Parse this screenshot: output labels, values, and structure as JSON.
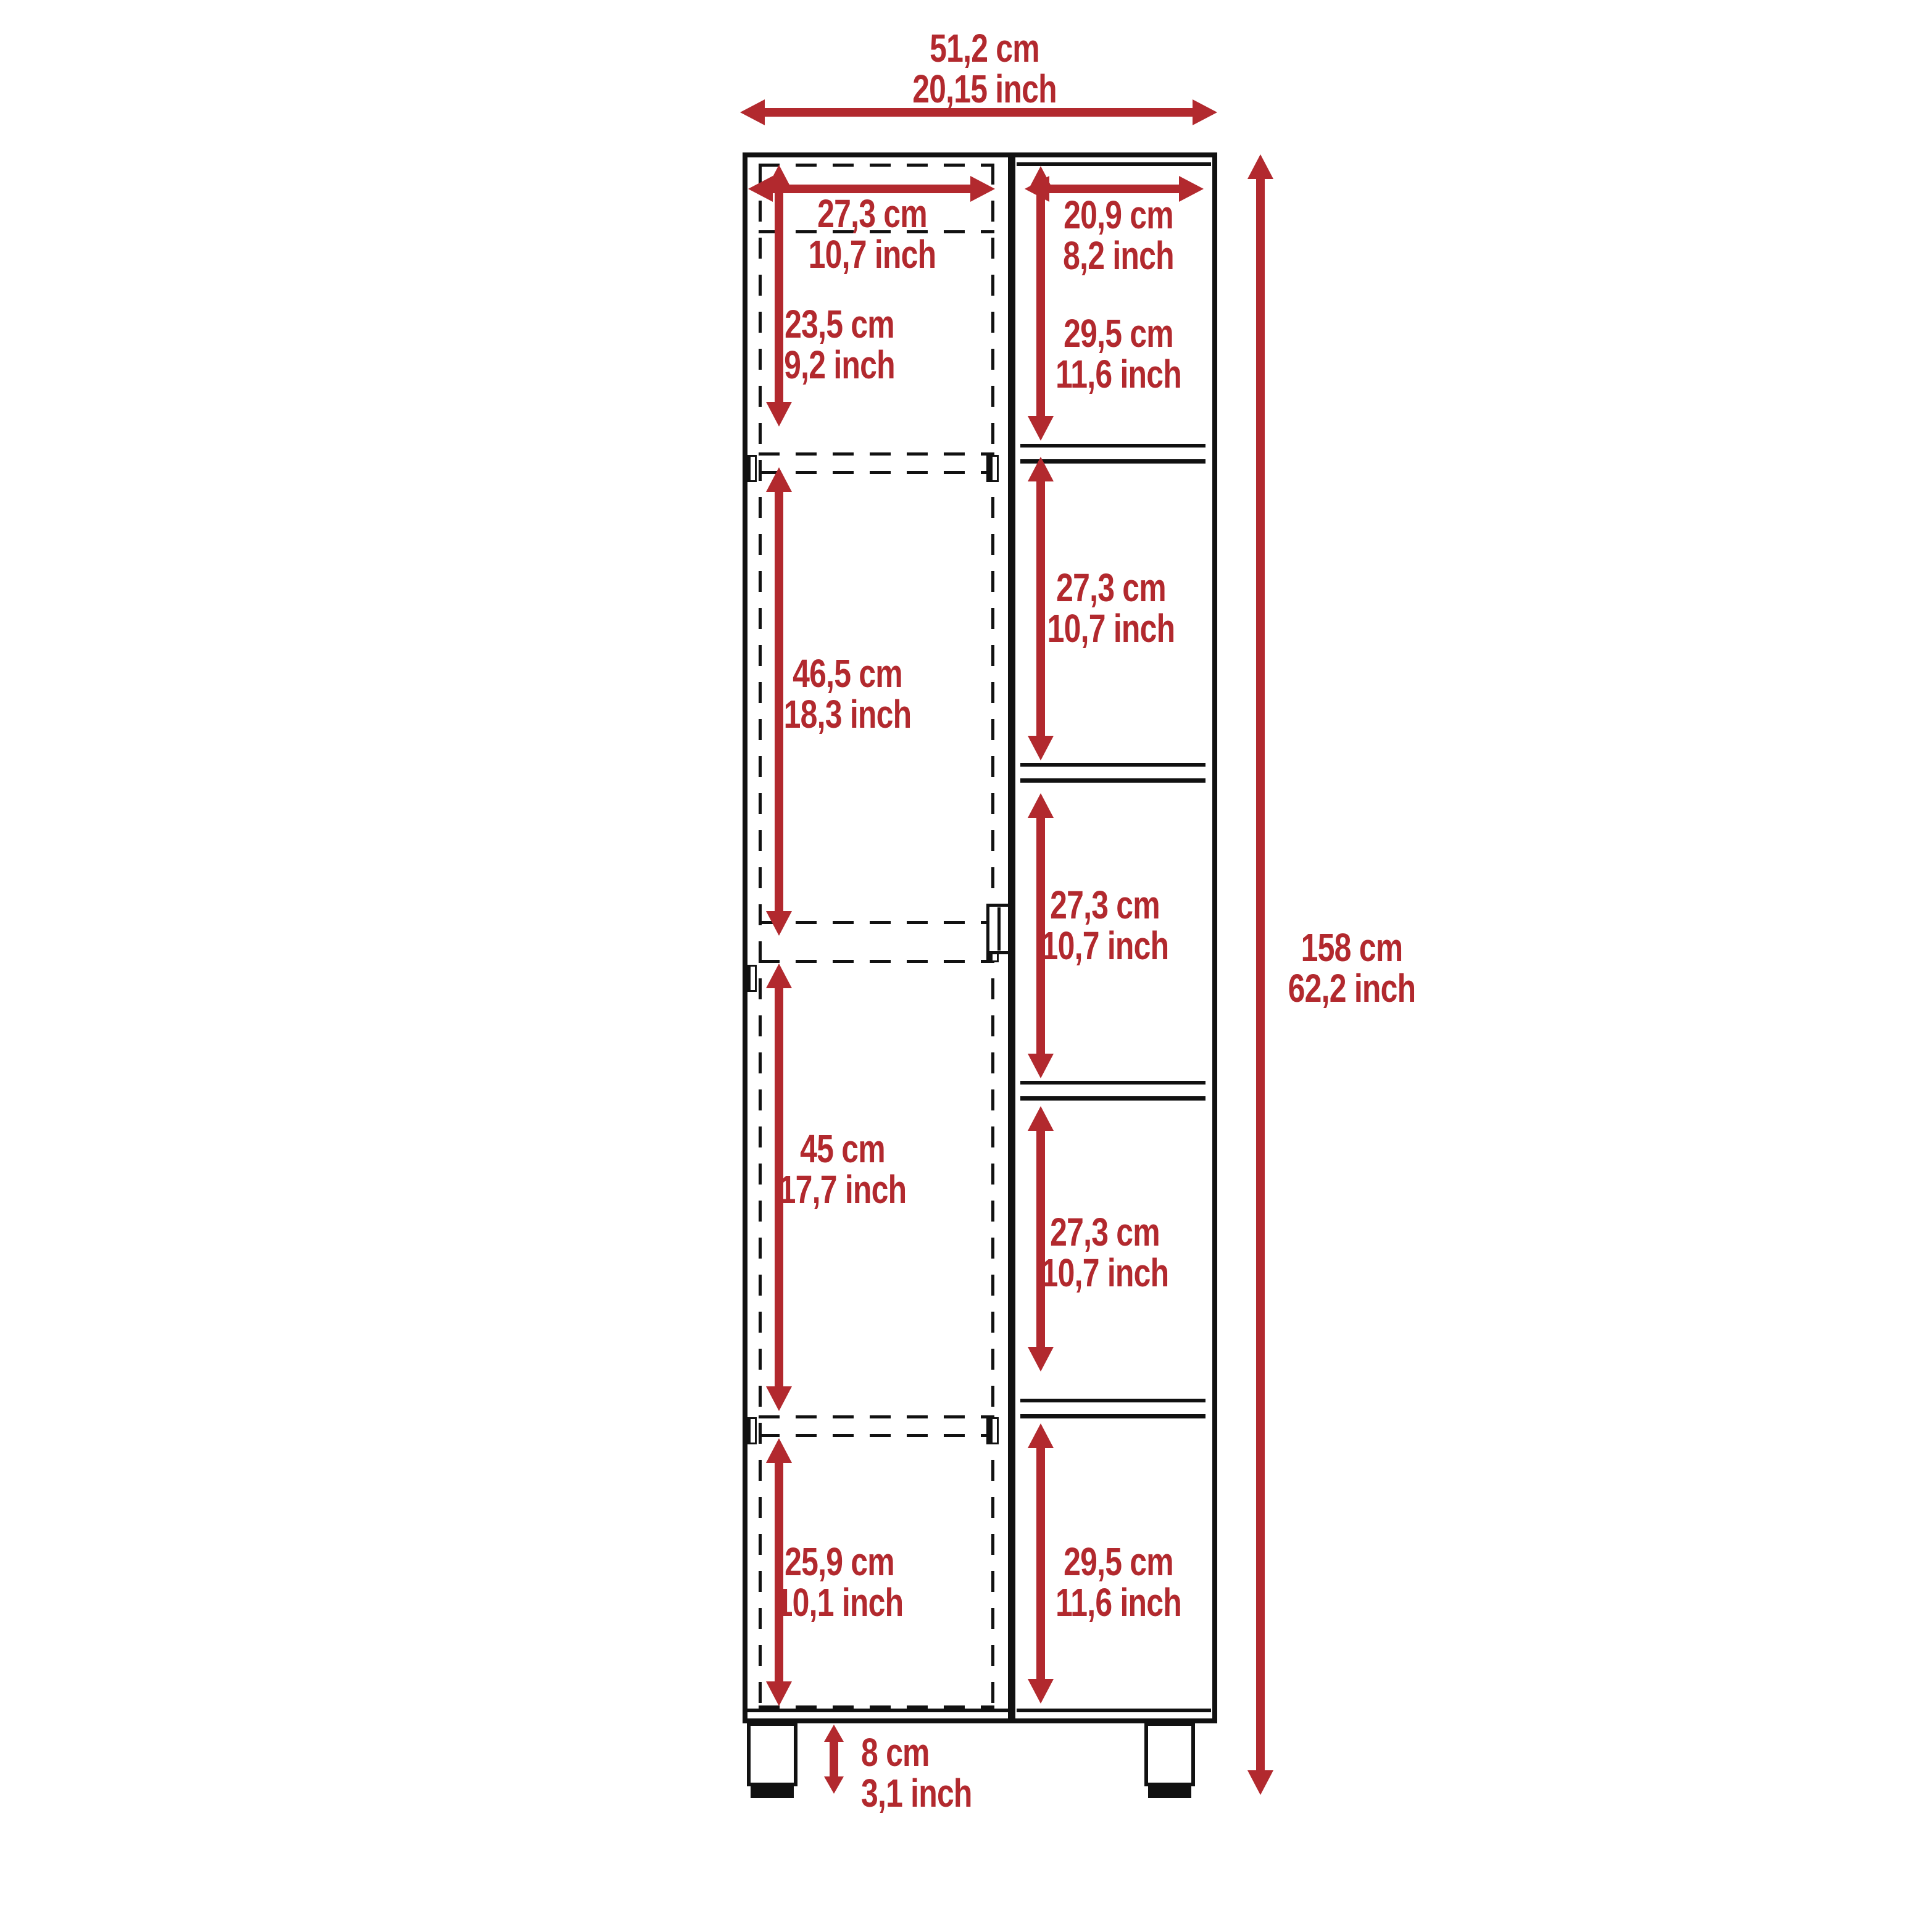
{
  "colors": {
    "dimension_red": "#b2292e",
    "line_black": "#111111",
    "background": "#ffffff"
  },
  "diagram": {
    "type": "furniture-dimension-drawing",
    "subject": "tall storage cabinet, front elevation: hinged door column (left, dashed) and 5 open shelf cells (right)",
    "overall": {
      "width_cm": "51,2 cm",
      "width_inch": "20,15 inch",
      "height_cm": "158 cm",
      "height_inch": "62,2 inch",
      "leg_height_cm": "8 cm",
      "leg_height_inch": "3,1 inch"
    },
    "door_column": {
      "width_cm": "27,3 cm",
      "width_inch": "10,7 inch",
      "sections": [
        {
          "cm": "23,5 cm",
          "inch": "9,2 inch"
        },
        {
          "cm": "46,5 cm",
          "inch": "18,3 inch"
        },
        {
          "cm": "45 cm",
          "inch": "17,7 inch"
        },
        {
          "cm": "25,9 cm",
          "inch": "10,1 inch"
        }
      ]
    },
    "shelf_column": {
      "width_cm": "20,9 cm",
      "width_inch": "8,2 inch",
      "cells": [
        {
          "cm": "29,5 cm",
          "inch": "11,6 inch"
        },
        {
          "cm": "27,3 cm",
          "inch": "10,7 inch"
        },
        {
          "cm": "27,3 cm",
          "inch": "10,7 inch"
        },
        {
          "cm": "27,3 cm",
          "inch": "10,7 inch"
        },
        {
          "cm": "29,5 cm",
          "inch": "11,6 inch"
        }
      ]
    }
  }
}
